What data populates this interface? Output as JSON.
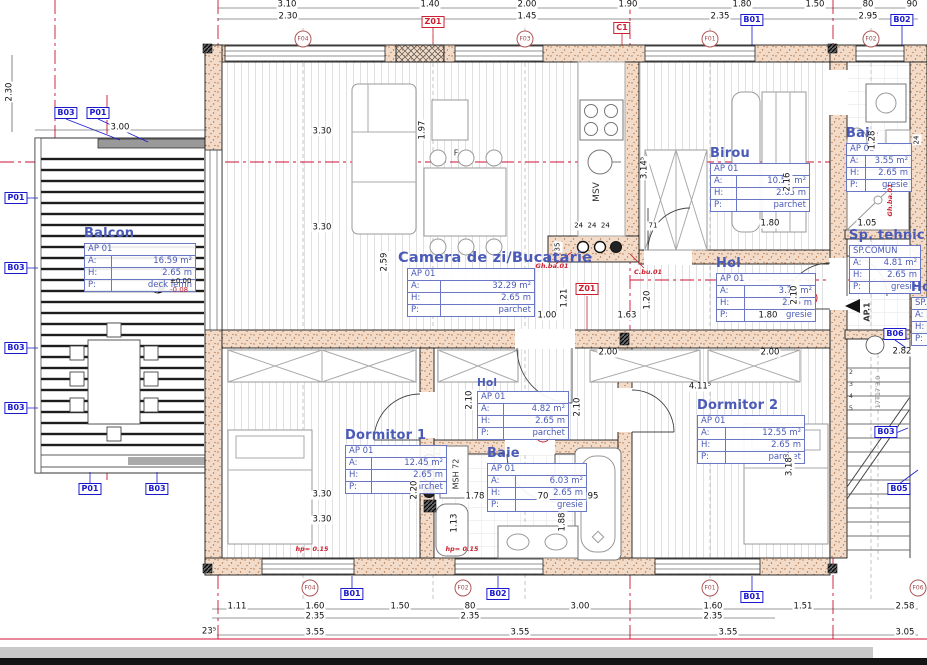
{
  "lbl": {
    "a": "A:",
    "h": "H:",
    "p": "P:"
  },
  "rooms": [
    {
      "title": "Balcon",
      "code": "AP 01",
      "aV": "16.59 m²",
      "hV": "2.65 m",
      "pV": "deck lemn"
    },
    {
      "title": "Camera de zi/Bucatarie",
      "code": "AP 01",
      "aV": "32.29 m²",
      "hV": "2.65 m",
      "pV": "parchet"
    },
    {
      "title": "Birou",
      "code": "AP 01",
      "aV": "10.58 m²",
      "hV": "2.65 m",
      "pV": "parchet"
    },
    {
      "title": "Baie",
      "code": "AP 01",
      "aV": "3.55 m²",
      "hV": "2.65 m",
      "pV": "gresie"
    },
    {
      "title": "Sp. tehnic",
      "code": "SP.COMUN",
      "aV": "4.81 m²",
      "hV": "2.65 m",
      "pV": "gresie"
    },
    {
      "title": "Hol",
      "code": "AP 01",
      "aV": "3.79 m²",
      "hV": "2.65 m",
      "pV": "gresie"
    },
    {
      "title": "Hol",
      "code": "AP 01",
      "aV": "4.82 m²",
      "hV": "2.65 m",
      "pV": "parchet"
    },
    {
      "title": "Dormitor 1",
      "code": "AP 01",
      "aV": "12.45 m²",
      "hV": "2.65 m",
      "pV": "parchet"
    },
    {
      "title": "Baie",
      "code": "AP 01",
      "aV": "6.03 m²",
      "hV": "2.65 m",
      "pV": "gresie"
    },
    {
      "title": "Dormitor 2",
      "code": "AP 01",
      "aV": "12.55 m²",
      "hV": "2.65 m",
      "pV": "parchet"
    },
    {
      "title": "Hol",
      "code": "SP.COMUN",
      "aV": "",
      "hV": "",
      "pV": ""
    }
  ],
  "dims": {
    "top1": [
      "3.10",
      "1.40",
      "2.00",
      "1.90",
      "1.80",
      "1.50",
      "80",
      "90"
    ],
    "top2": [
      "2.30",
      "1.45",
      "2.35",
      "2.95"
    ],
    "bottom1": [
      "1.11",
      "1.60",
      "1.50",
      "80",
      "3.00",
      "1.60",
      "1.51",
      "2.58"
    ],
    "bottom2": [
      "2.35",
      "2.35",
      "2.35"
    ],
    "bottom3": [
      "23⁵",
      "3.55",
      "3.55",
      "3.55",
      "3.05"
    ],
    "left": [
      "2.30",
      "3.00"
    ],
    "d": [
      "3.30",
      "3.30",
      "1.97",
      "2.59",
      "1.21",
      "1.00",
      "1.63",
      "1.20",
      "2.16",
      "1.80",
      "1.05",
      "1.80",
      "2.10",
      "2.00",
      "2.00",
      "4.11⁵",
      "1.78",
      "70",
      "95",
      "1.13",
      "1.88",
      "2.20",
      "24  24  24",
      "71",
      "3.30",
      "3.30",
      "2.10",
      "2.10",
      "3.14⁵",
      "3.18⁵",
      "1.28",
      "24",
      "2.82",
      "35"
    ]
  },
  "btags": [
    "B03",
    "P01",
    "P01",
    "B03",
    "B03",
    "B03",
    "P01",
    "B03",
    "B01",
    "B02",
    "B01",
    "B02",
    "B01",
    "B06",
    "B03",
    "B05"
  ],
  "rtags": [
    "Z01",
    "Z01",
    "C1"
  ],
  "ftags": [
    "F04",
    "F03",
    "F01",
    "F02",
    "F04",
    "F02",
    "F01",
    "F06"
  ],
  "notes": {
    "msv": "MSV",
    "msh": "MSH 72",
    "ap1": "AP.1",
    "lvl0": "±0.00",
    "lvlm": "-0.08",
    "gh1": "Gh.ba.01",
    "cbu": "C.bu.01",
    "gh2": "Gh.ba.01",
    "hp1": "hp= 0.15",
    "hp2": "hp= 0.15",
    "stair": "17T17'3.0",
    "f": "F"
  },
  "steps": [
    "2",
    "3",
    "4",
    "5"
  ],
  "colors": {
    "blue": "#4a5ab8",
    "tagblue": "#1a1acc",
    "red": "#cc2030",
    "wall": "#f2dcc9"
  }
}
